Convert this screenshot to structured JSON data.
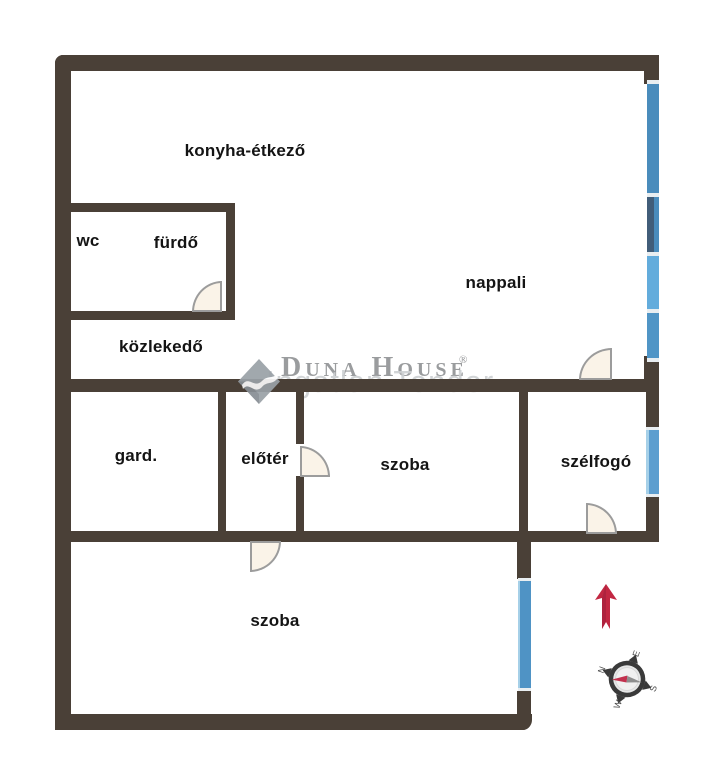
{
  "page": {
    "type": "apartment-floor-plan",
    "brand": "Duna House"
  },
  "rooms": {
    "konyha_etkezo": {
      "label": "konyha-étkező"
    },
    "wc": {
      "label": "wc"
    },
    "furdo": {
      "label": "fürdő"
    },
    "nappali": {
      "label": "nappali"
    },
    "kozlekedo": {
      "label": "közlekedő"
    },
    "gard": {
      "label": "gard."
    },
    "eloter": {
      "label": "előtér"
    },
    "szoba_middle": {
      "label": "szoba"
    },
    "szelfogo": {
      "label": "szélfogó"
    },
    "szoba_bottom": {
      "label": "szoba"
    }
  },
  "watermark": {
    "brand_text": "Duna House",
    "registered_mark": "®",
    "subtext": "Ingatlan Tender"
  },
  "compass": {
    "north": "N",
    "east": "E",
    "south": "S",
    "west": "W"
  },
  "colors": {
    "wall": "#4a4037",
    "door_fill": "#faf3e8",
    "door_stroke": "#9c9c9c",
    "label_text": "#141414",
    "window_steel": "#4a8cbc",
    "window_dark": "#415d79",
    "window_light": "#63acdc",
    "window_mid": "#5095c6",
    "window_szelfogo": "#5d9ecf",
    "window_bottom": "#4f93c5",
    "window_cap": "#e9eef1",
    "window_edge": "#a6d0e8",
    "watermark_gray": "#909294",
    "watermark_light": "#cdd0d2",
    "logo_gray": "#9aa1a7",
    "arrow_red": "#c22742",
    "arrow_red_dark": "#9e1f3d",
    "compass_ring": "#3a3a3a",
    "needle_red": "#c2314e",
    "needle_gray": "#8e8e8e"
  }
}
